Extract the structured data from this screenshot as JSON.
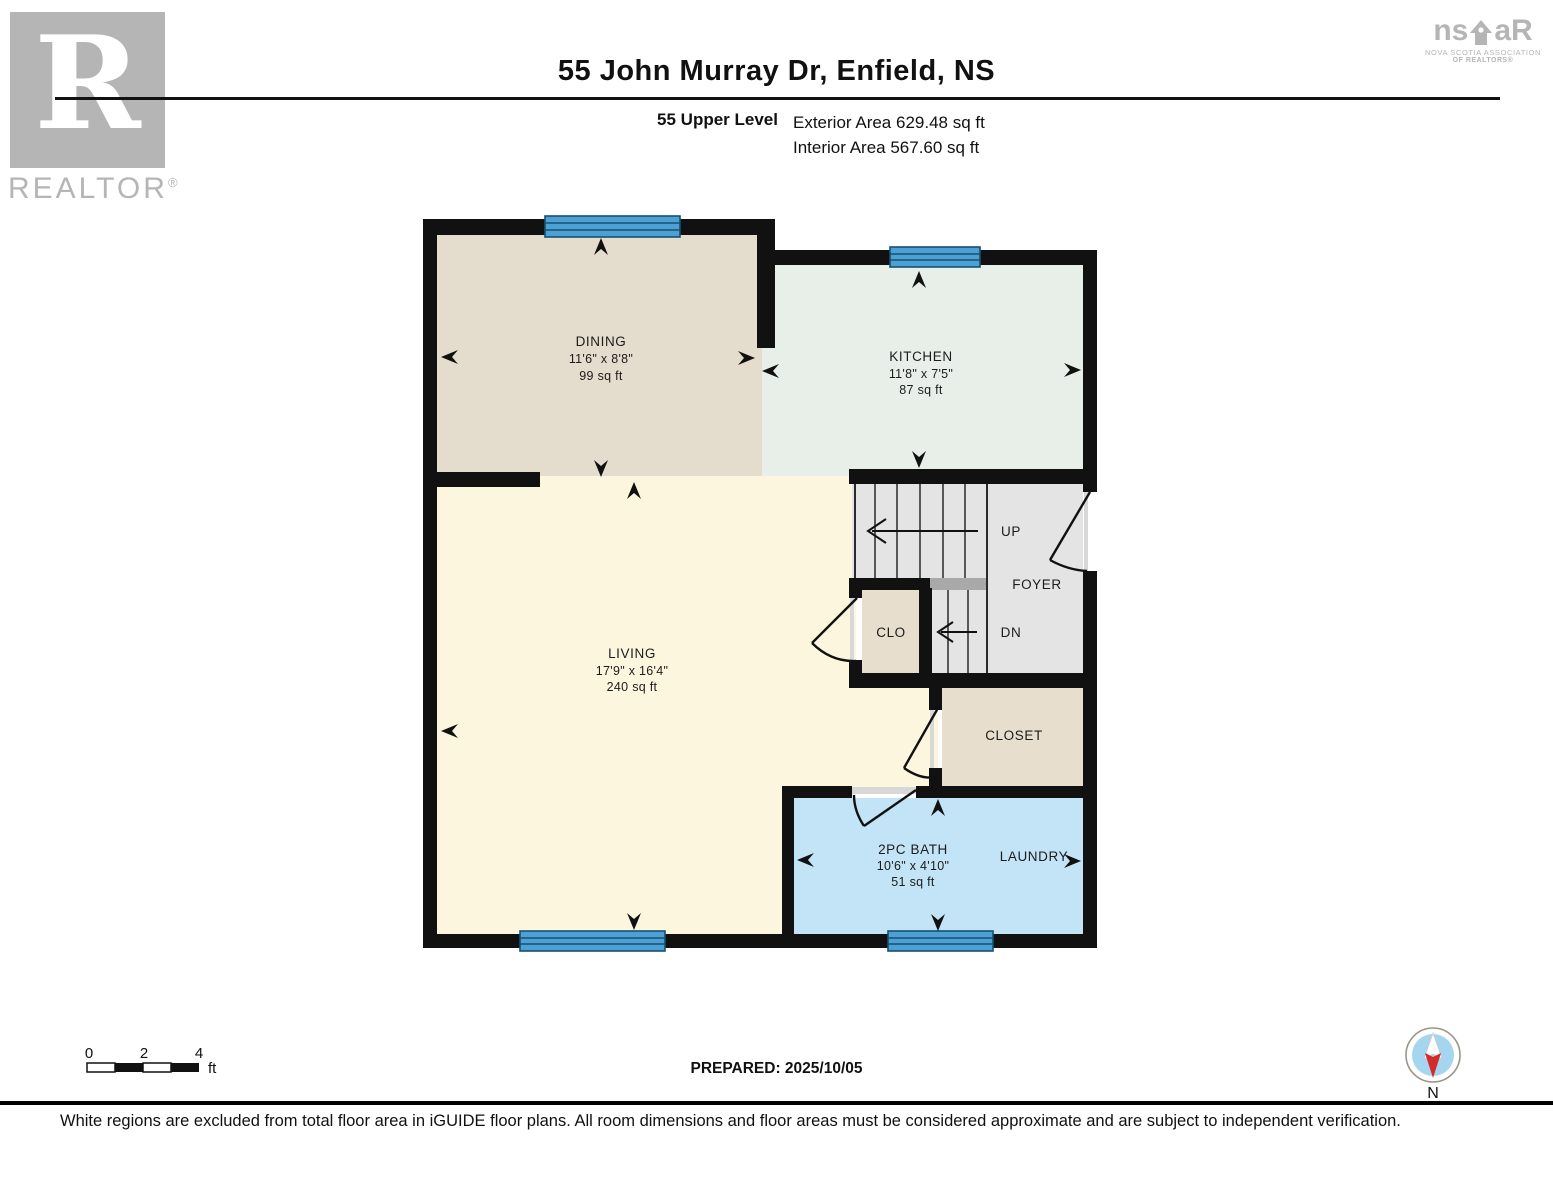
{
  "header": {
    "title": "55 John Murray Dr, Enfield, NS",
    "level_label": "55 Upper Level",
    "exterior_area": "Exterior Area 629.48 sq ft",
    "interior_area": "Interior Area 567.60 sq ft"
  },
  "logos": {
    "realtor": {
      "letter": "R",
      "word": "REALTOR",
      "registered": "®"
    },
    "nsar": {
      "part1": "ns",
      "part2": "aR",
      "sub1": "NOVA SCOTIA ASSOCIATION",
      "sub2": "OF REALTORS®"
    }
  },
  "rooms": {
    "dining": {
      "name": "DINING",
      "dims": "11'6\" x 8'8\"",
      "area": "99 sq ft"
    },
    "kitchen": {
      "name": "KITCHEN",
      "dims": "11'8\" x 7'5\"",
      "area": "87 sq ft"
    },
    "living": {
      "name": "LIVING",
      "dims": "17'9\" x 16'4\"",
      "area": "240 sq ft"
    },
    "bath": {
      "name": "2PC BATH",
      "dims": "10'6\" x 4'10\"",
      "area": "51 sq ft"
    },
    "laundry": {
      "name": "LAUNDRY"
    },
    "closet": {
      "name": "CLOSET"
    },
    "clo": {
      "name": "CLO"
    },
    "foyer": {
      "name": "FOYER"
    },
    "stairs_up": {
      "name": "UP"
    },
    "stairs_down": {
      "name": "DN"
    }
  },
  "colors": {
    "wall": "#111111",
    "dining": "#e4dccd",
    "kitchen": "#e7efe8",
    "living": "#fdf6df",
    "bath": "#c2e4f6",
    "closet_beige": "#e7decd",
    "stairs_gray": "#e4e4e4",
    "landing_gray": "#a9a9a9",
    "window_blue": "#4da0d6",
    "window_frame": "#17506e",
    "logo_gray": "#b5b5b5",
    "compass_blue": "#a5d5ef",
    "compass_red": "#d42a2a"
  },
  "footer": {
    "scale": {
      "t0": "0",
      "t2": "2",
      "t4": "4",
      "unit": "ft"
    },
    "prepared": "PREPARED: 2025/10/05",
    "compass_label": "N",
    "disclaimer": "White regions are excluded from total floor area in iGUIDE floor plans. All room dimensions and floor areas must be considered approximate and are subject to independent verification."
  }
}
